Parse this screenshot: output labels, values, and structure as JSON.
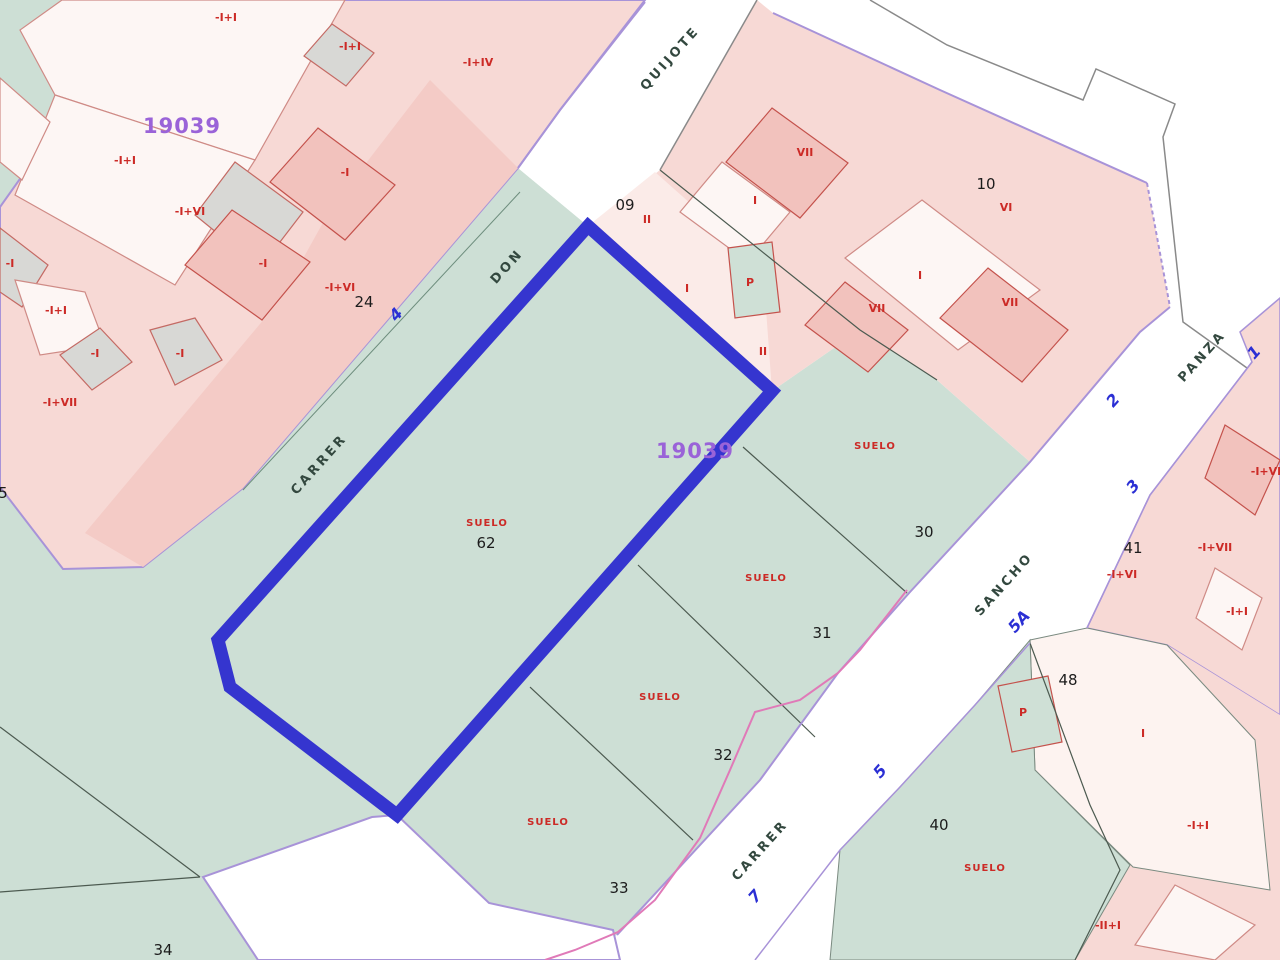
{
  "map_type": "cadastral-parcel-map",
  "colors": {
    "suelo_green": "#cddfd5",
    "block_pink": "#f7d9d5",
    "block_pink_dark": "#f4cbc6",
    "parcel_pale_pink": "#fbebe8",
    "building_white": "#fdf6f4",
    "building_grey": "#d8d8d5",
    "building_dark_pink": "#f2c2bd",
    "cream_parcel": "#fdf3f0",
    "boundary_purple": "#a893d8",
    "highlight_blue": "#3535cf",
    "meander_pink": "#e07ab8",
    "label_red": "#cc2a26",
    "label_blue": "#2b2fd4",
    "label_purple": "#9a63d8",
    "street_text": "#33483f",
    "parcel_number_text": "#1c1c1c"
  },
  "labels": {
    "zone_codes": {
      "style": "zone",
      "name": "zone-code-label",
      "items": [
        {
          "text": "19039",
          "x": 182,
          "y": 133
        },
        {
          "text": "19039",
          "x": 695,
          "y": 458
        }
      ]
    },
    "parcel_numbers": {
      "style": "pnum",
      "name": "parcel-number-label",
      "items": [
        {
          "text": "24",
          "x": 364,
          "y": 307
        },
        {
          "text": "09",
          "x": 625,
          "y": 210
        },
        {
          "text": "10",
          "x": 986,
          "y": 189
        },
        {
          "text": "30",
          "x": 924,
          "y": 537
        },
        {
          "text": "31",
          "x": 822,
          "y": 638
        },
        {
          "text": "32",
          "x": 723,
          "y": 760
        },
        {
          "text": "33",
          "x": 619,
          "y": 893
        },
        {
          "text": "34",
          "x": 163,
          "y": 955
        },
        {
          "text": "40",
          "x": 939,
          "y": 830
        },
        {
          "text": "41",
          "x": 1133,
          "y": 553
        },
        {
          "text": "48",
          "x": 1068,
          "y": 685
        },
        {
          "text": "62",
          "x": 486,
          "y": 548
        },
        {
          "text": "5",
          "x": 3,
          "y": 498
        }
      ]
    },
    "street_names": {
      "style": "sname",
      "name": "street-name-label",
      "items": [
        {
          "text": "QUIJOTE",
          "x": 673,
          "y": 61,
          "rot": -48
        },
        {
          "text": "DON",
          "x": 510,
          "y": 269,
          "rot": -48
        },
        {
          "text": "CARRER",
          "x": 322,
          "y": 467,
          "rot": -48
        },
        {
          "text": "PANZA",
          "x": 1205,
          "y": 359,
          "rot": -48
        },
        {
          "text": "SANCHO",
          "x": 1007,
          "y": 587,
          "rot": -48
        },
        {
          "text": "CARRER",
          "x": 763,
          "y": 853,
          "rot": -48
        }
      ]
    },
    "street_numbers": {
      "style": "snum",
      "name": "street-number-label",
      "items": [
        {
          "text": "4",
          "x": 400,
          "y": 318,
          "rot": -48
        },
        {
          "text": "1",
          "x": 1258,
          "y": 356,
          "rot": -48
        },
        {
          "text": "2",
          "x": 1117,
          "y": 404,
          "rot": -48
        },
        {
          "text": "3",
          "x": 1137,
          "y": 490,
          "rot": -48
        },
        {
          "text": "5A",
          "x": 1023,
          "y": 625,
          "rot": -48
        },
        {
          "text": "5",
          "x": 884,
          "y": 775,
          "rot": -48
        },
        {
          "text": "7",
          "x": 759,
          "y": 900,
          "rot": -48
        }
      ]
    },
    "suelo_labels": {
      "style": "suelo",
      "name": "suelo-label",
      "items": [
        {
          "text": "SUELO",
          "x": 487,
          "y": 526
        },
        {
          "text": "SUELO",
          "x": 875,
          "y": 449
        },
        {
          "text": "SUELO",
          "x": 766,
          "y": 581
        },
        {
          "text": "SUELO",
          "x": 660,
          "y": 700
        },
        {
          "text": "SUELO",
          "x": 548,
          "y": 825
        },
        {
          "text": "SUELO",
          "x": 985,
          "y": 871
        }
      ]
    },
    "building_codes": {
      "style": "bcode",
      "name": "building-code-label",
      "items": [
        {
          "text": "-I+I",
          "x": 226,
          "y": 21
        },
        {
          "text": "-I+I",
          "x": 350,
          "y": 50
        },
        {
          "text": "-I+IV",
          "x": 478,
          "y": 66
        },
        {
          "text": "-I+I",
          "x": 125,
          "y": 164
        },
        {
          "text": "-I+VI",
          "x": 190,
          "y": 215
        },
        {
          "text": "-I",
          "x": 345,
          "y": 176
        },
        {
          "text": "-I",
          "x": 263,
          "y": 267
        },
        {
          "text": "-I",
          "x": 10,
          "y": 267
        },
        {
          "text": "-I+I",
          "x": 56,
          "y": 314
        },
        {
          "text": "-I",
          "x": 95,
          "y": 357
        },
        {
          "text": "-I",
          "x": 180,
          "y": 357
        },
        {
          "text": "-I+VII",
          "x": 60,
          "y": 406
        },
        {
          "text": "-I+VI",
          "x": 340,
          "y": 291
        },
        {
          "text": "VII",
          "x": 805,
          "y": 156
        },
        {
          "text": "I",
          "x": 755,
          "y": 204
        },
        {
          "text": "II",
          "x": 647,
          "y": 223
        },
        {
          "text": "I",
          "x": 687,
          "y": 292
        },
        {
          "text": "P",
          "x": 750,
          "y": 286
        },
        {
          "text": "II",
          "x": 763,
          "y": 355
        },
        {
          "text": "VII",
          "x": 877,
          "y": 312
        },
        {
          "text": "VI",
          "x": 1006,
          "y": 211
        },
        {
          "text": "I",
          "x": 920,
          "y": 279
        },
        {
          "text": "VII",
          "x": 1010,
          "y": 306
        },
        {
          "text": "-I+VI",
          "x": 1266,
          "y": 475
        },
        {
          "text": "-I+VI",
          "x": 1122,
          "y": 578
        },
        {
          "text": "-I+VII",
          "x": 1215,
          "y": 551
        },
        {
          "text": "-I+I",
          "x": 1237,
          "y": 615
        },
        {
          "text": "P",
          "x": 1023,
          "y": 716
        },
        {
          "text": "I",
          "x": 1143,
          "y": 737
        },
        {
          "text": "-I+I",
          "x": 1198,
          "y": 829
        },
        {
          "text": "-II+I",
          "x": 1108,
          "y": 929
        }
      ]
    }
  }
}
